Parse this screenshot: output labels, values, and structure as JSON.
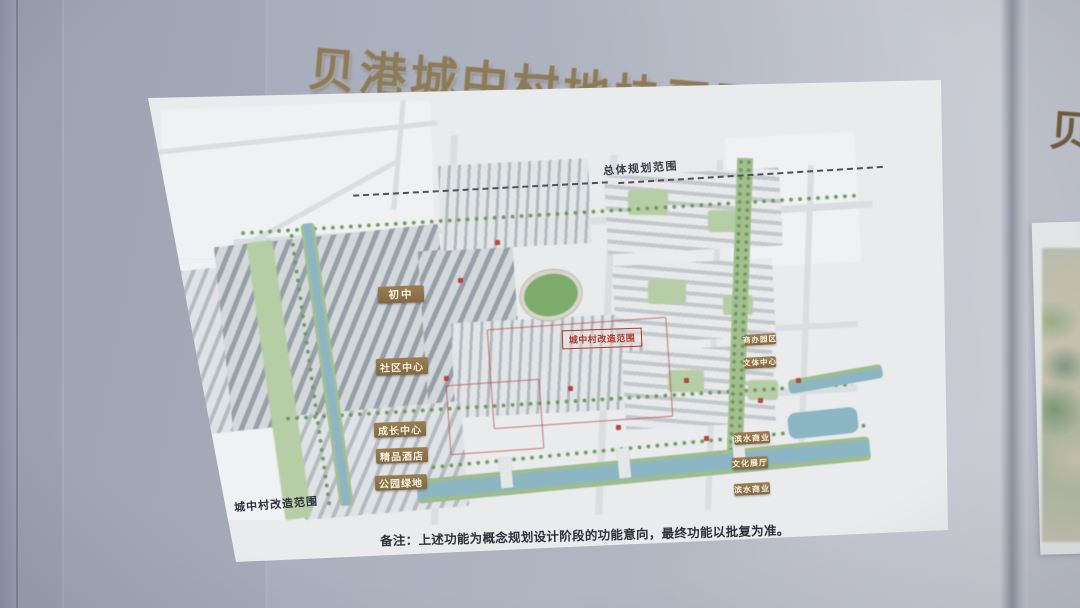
{
  "photo": {
    "board_title": "贝港城中村地块平面图",
    "adjacent_board_title_partial": "贝"
  },
  "map": {
    "boundary_label": "总体规划范围",
    "zone_labels": [
      "初中",
      "社区中心",
      "成长中心",
      "精品酒店",
      "公园绿地",
      "商办园区",
      "文体中心",
      "滨水商业",
      "文化展厅",
      "滨水商业"
    ],
    "red_zone_label": "城中村改造范围",
    "legend_label": "城中村改造范围",
    "note": "备注：上述功能为概念规划设计阶段的功能意向，最终功能以批复为准。"
  },
  "colors": {
    "board_background": "#aeb3c1",
    "title_text": "#8d7a57",
    "panel_background": "#e9ebed",
    "zone_label_background": "#8f7349",
    "zone_label_text": "#f7f1e2",
    "red_accent": "#b5372c",
    "water": "#8cb6c4",
    "green": "#9dba8c",
    "note_text": "#2d323b"
  }
}
